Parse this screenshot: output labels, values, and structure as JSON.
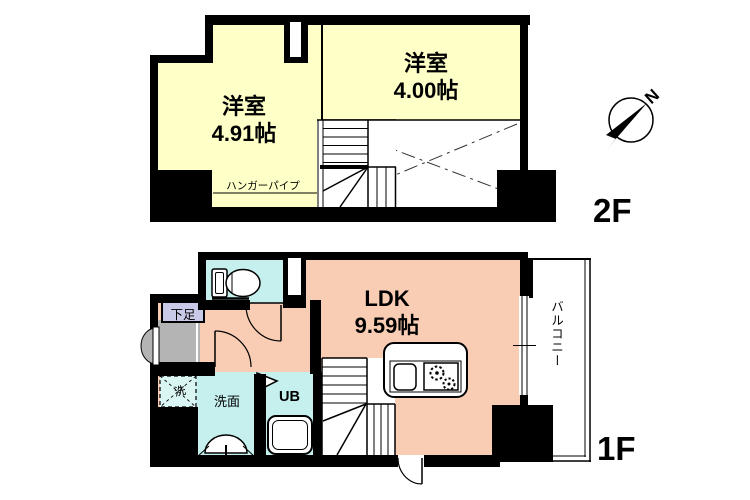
{
  "compass": {
    "label": "N"
  },
  "floor2": {
    "floor_label": "2F",
    "room_left": {
      "name": "洋室",
      "size": "4.91帖"
    },
    "room_right": {
      "name": "洋室",
      "size": "4.00帖"
    },
    "hanger_pipe_label": "ハンガーパイプ"
  },
  "floor1": {
    "floor_label": "1F",
    "ldk": {
      "name": "LDK",
      "size": "9.59帖"
    },
    "shoe_storage_label": "下足",
    "washer_label": "洗",
    "washroom_label": "洗面",
    "unit_bath_label": "UB",
    "balcony_label": "バルコニー"
  },
  "colors": {
    "wall": "#000000",
    "room_yellow": "#ffffc8",
    "room_salmon": "#f9cdb4",
    "room_cyan": "#c5f0ee",
    "shoe_box_lavender": "#c9c9e8",
    "entry_gray": "#b4b4b4"
  }
}
